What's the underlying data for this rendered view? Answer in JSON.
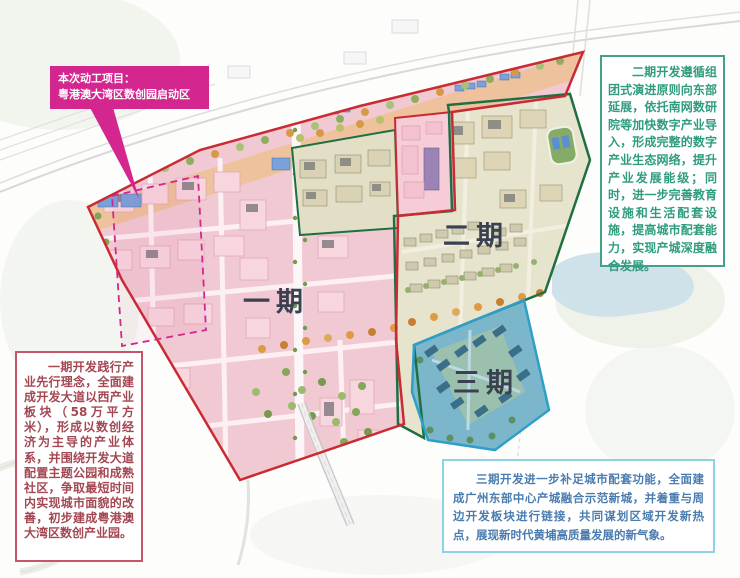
{
  "callout": {
    "line1": "本次动工项目：",
    "line2": "粤港澳大湾区数创园启动区"
  },
  "map": {
    "phase1_label": "一期",
    "phase2_label": "二期",
    "phase3_label": "三期"
  },
  "notes": {
    "phase1": "一期开发践行产业先行理念，全面建成开发大道以西产业板块（58万平方米），形成以数创经济为主导的产业体系，并围绕开发大道配置主题公园和成熟社区，争取最短时间内实现城市面貌的改善，初步建成粤港澳大湾区数创产业园。",
    "phase2": "二期开发遵循组团式演进原则向东部延展，依托南网数研院等加快数字产业导入，形成完整的数字产业生态网络，提升产业发展能级；同时，进一步完善教育设施和生活配套设施，提高城市配套能力，实现产城深度融合发展。",
    "phase3": "三期开发进一步补足城市配套功能，全面建成广州东部中心产城融合示范新城，并着重与周边开发板块进行链接，共同谋划区域开发新热点，展现新时代黄埔高质量发展的新气象。"
  },
  "colors": {
    "callout_bg": "#d4268f",
    "phase1_border": "#c92b33",
    "phase2_border": "#1f6f43",
    "phase3_border": "#2e9fc9",
    "note1_border": "#c65568",
    "note1_text": "#a34853",
    "note2_border": "#44a088",
    "note2_text": "#2f9c80",
    "note3_border": "#8ed2e4",
    "note3_text": "#4a7cb0",
    "label_color": "#3a4150"
  }
}
